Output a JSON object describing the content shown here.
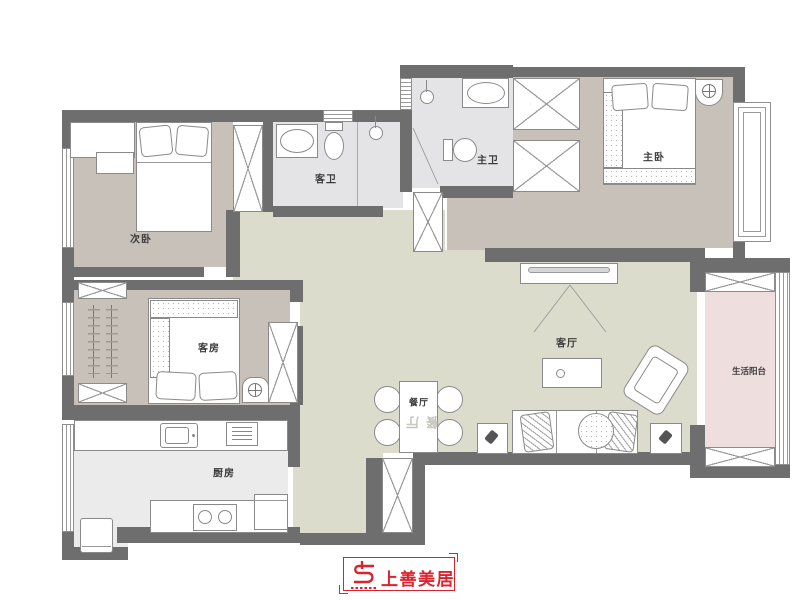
{
  "palette": {
    "wall": "#6e6e6e",
    "floor_bedroom": "#c8c1b9",
    "floor_hall": "#dcdccd",
    "floor_bath": "#e4e4e6",
    "floor_kitchen": "#ebebeb",
    "floor_balcony": "#eedfde",
    "line": "#8a8a8a",
    "label": "#3c3c3c",
    "brand_red": "#d9232e"
  },
  "rooms": {
    "secondary_bedroom": {
      "label": "次卧"
    },
    "guest_bathroom": {
      "label": "客卫"
    },
    "master_bathroom": {
      "label": "主卫"
    },
    "master_bedroom": {
      "label": "主卧"
    },
    "guest_room": {
      "label": "客房"
    },
    "kitchen": {
      "label": "厨房"
    },
    "dining_room": {
      "label": "餐厅"
    },
    "living_room": {
      "label": "客厅"
    },
    "balcony": {
      "label": "生活阳台"
    }
  },
  "logo": {
    "brand": "上善美居"
  }
}
